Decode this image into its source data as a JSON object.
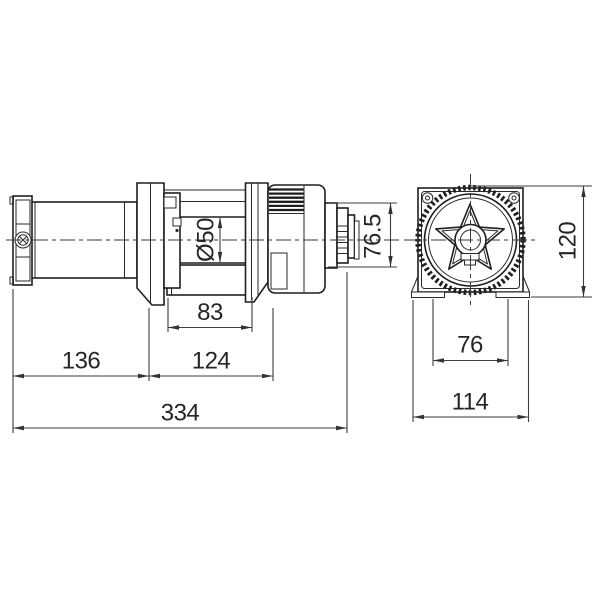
{
  "drawing": {
    "kind": "two-view dimensioned engineering drawing of an electric winch",
    "background": "#ffffff",
    "colors": {
      "object_line": "#1f1f1f",
      "dimension_line": "#3d3d3d",
      "text": "#262626"
    },
    "dimensions": {
      "drum_diameter": "Ø50",
      "end_cap_height": "76.5",
      "drum_length": "83",
      "motor_section_length": "136",
      "gear_section_length": "124",
      "overall_length": "334",
      "mount_hole_spacing": "76",
      "base_width": "114",
      "overall_height": "120"
    }
  }
}
